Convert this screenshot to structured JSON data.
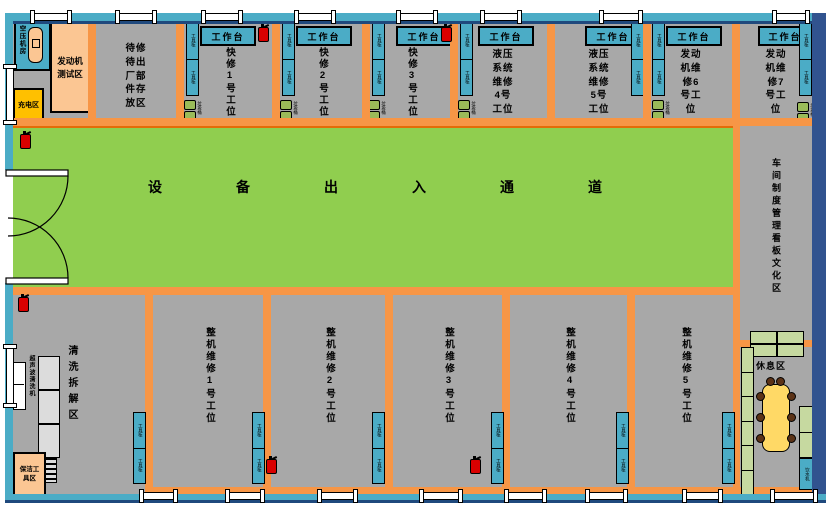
{
  "colors": {
    "floor_gray": "#A8A8A8",
    "passage_green": "#90CE4F",
    "passage_border_orange": "#E36C09",
    "divider_orange": "#F79646",
    "wall_light_blue": "#4BACC6",
    "wall_navy": "#1F497D",
    "wall_right_blue": "#31538F",
    "furniture_cyan": "#4BACC6",
    "room_peach": "#FBC693",
    "charging_yellow": "#FFC000",
    "bin_olive": "#9ABB59",
    "rest_green": "#C6D9A0",
    "table_yellow": "#FFD966",
    "extinguisher_red": "#D90000"
  },
  "rooms": {
    "air_compressor": "空压机房",
    "engine_test_lines": [
      "发动机",
      "测试区"
    ],
    "charging": "充电区",
    "pending_storage_name": "待修待出厂部件存放区",
    "pending_storage_lines": [
      "待修",
      "待出",
      "厂部",
      "件存",
      "放区"
    ],
    "passage": "设备出入通道",
    "cleaning": "清洗拆解区",
    "cleaning_machine": "超声波清洗机",
    "cleaning_tools_lines": [
      "保洁工",
      "具区"
    ],
    "board_culture": "车间制度管理看板文化区",
    "rest": "休息区"
  },
  "bays_top": [
    {
      "name": "快修1号工位"
    },
    {
      "name": "快修2号工位"
    },
    {
      "name": "快修3号工位"
    },
    {
      "name": "液压系统维修4号工位",
      "lines": [
        "液压",
        "系统",
        "维修",
        "4号",
        "工位"
      ]
    },
    {
      "name": "液压系统维修5号工位",
      "lines": [
        "液压",
        "系统",
        "维修",
        "5号",
        "工位"
      ]
    },
    {
      "name": "发动机维修6号工位",
      "lines": [
        "发动",
        "机维",
        "修6",
        "号工",
        "位"
      ]
    },
    {
      "name": "发动机维修7号工位",
      "lines": [
        "发动",
        "机维",
        "修7",
        "号工",
        "位"
      ]
    }
  ],
  "bays_bottom": [
    {
      "name": "整机维修1号工位"
    },
    {
      "name": "整机维修2号工位"
    },
    {
      "name": "整机维修3号工位"
    },
    {
      "name": "整机维修4号工位"
    },
    {
      "name": "整机维修5号工位"
    }
  ],
  "furniture": {
    "workbench": "工作台",
    "cabinet": "工具柜",
    "bin": "垃圾桶",
    "water_dispenser": "饮水机"
  }
}
